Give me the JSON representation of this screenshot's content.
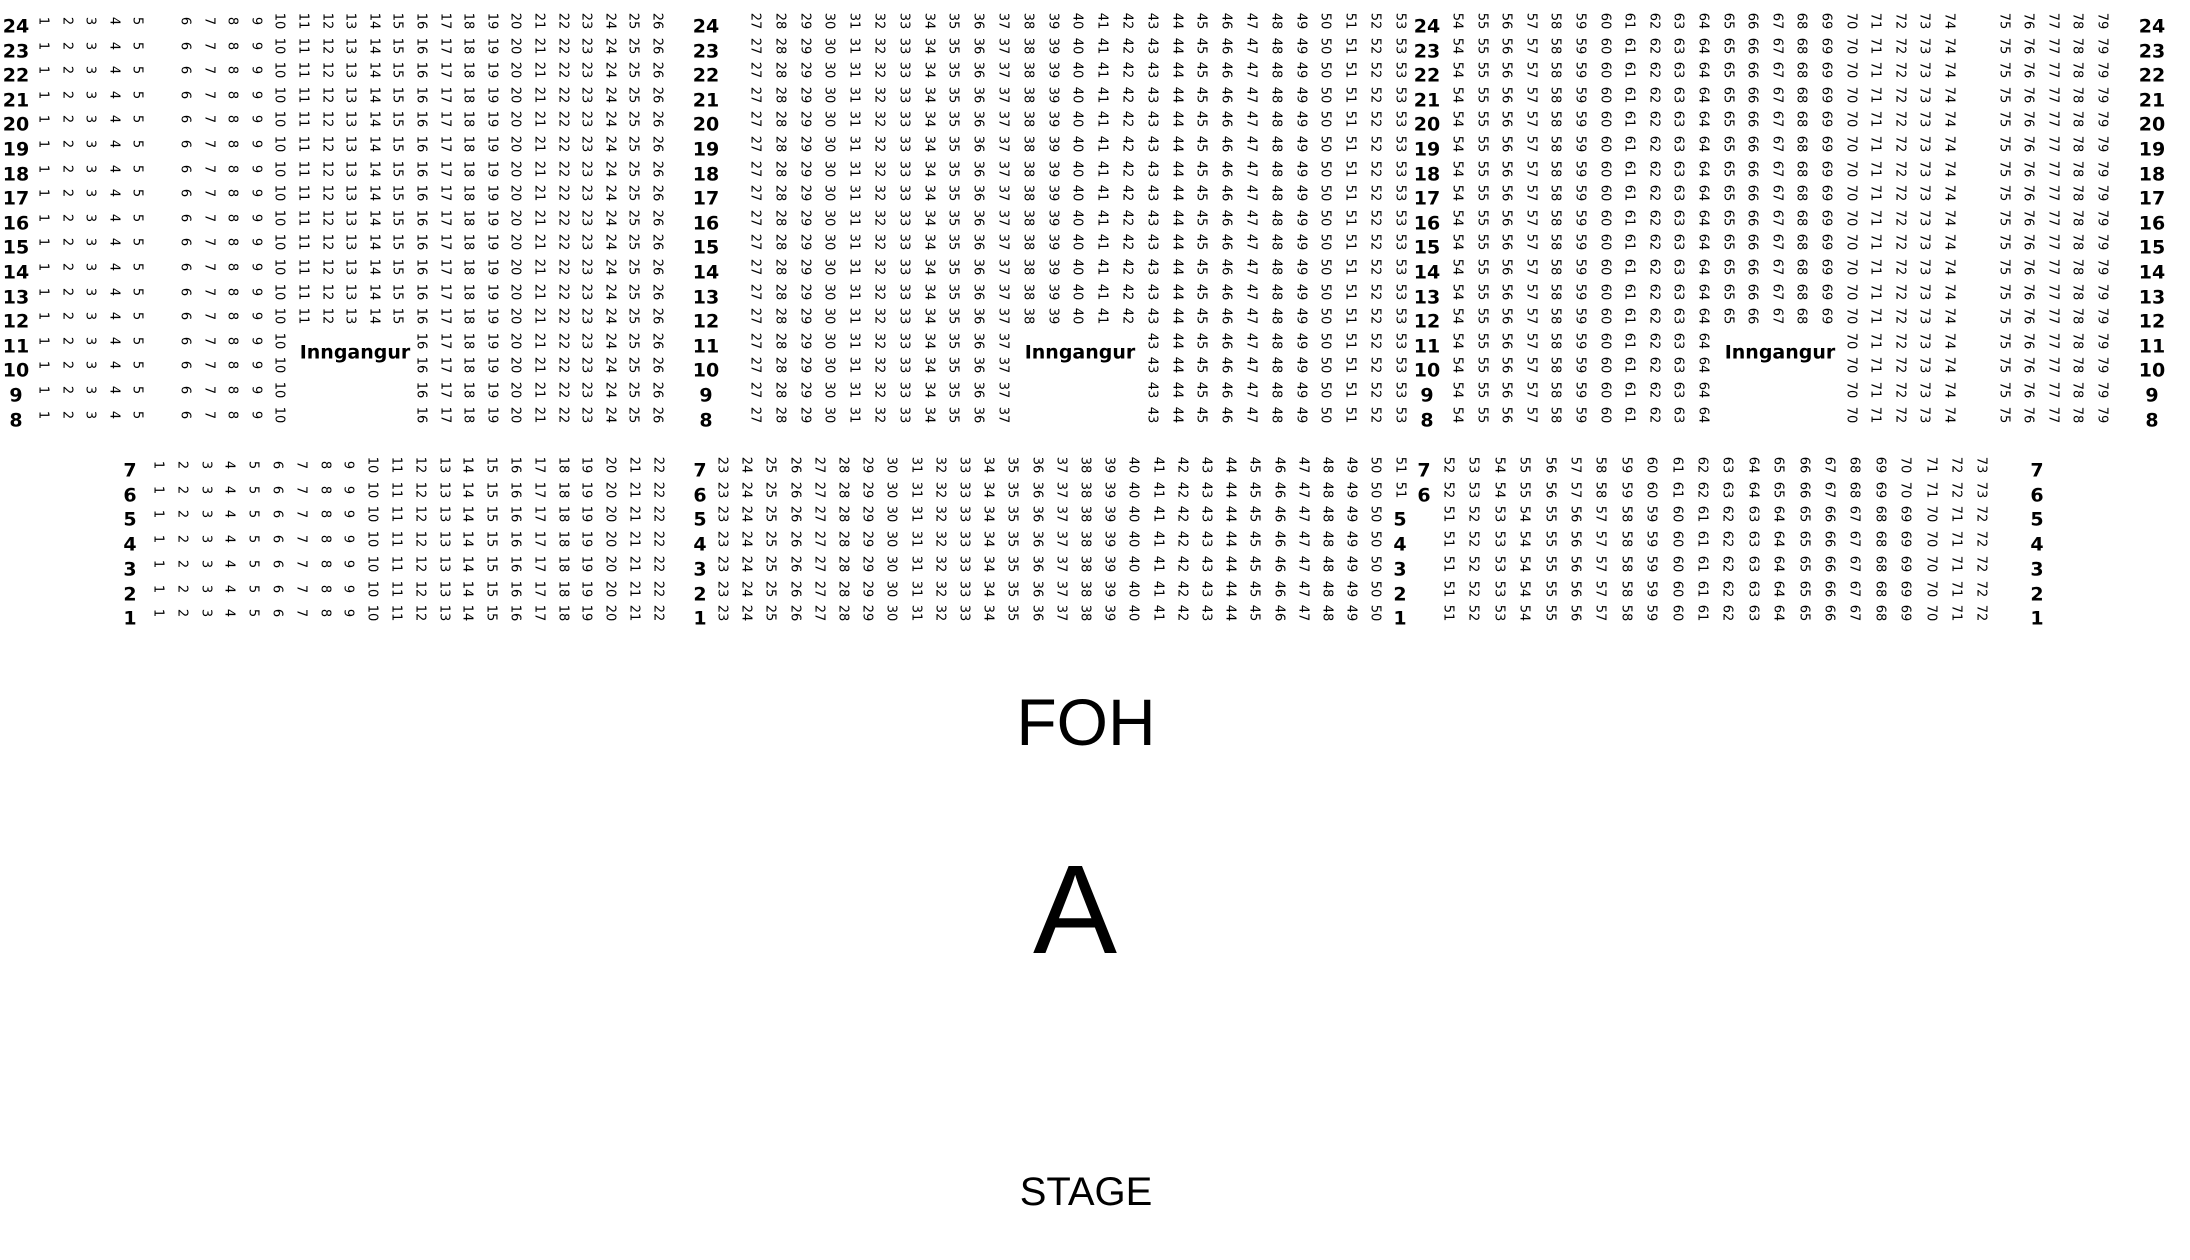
{
  "page": {
    "background_color": "#ffffff",
    "text_color": "#000000"
  },
  "labels": {
    "entrance": "Inngangur",
    "foh": "FOH",
    "section": "A",
    "stage": "STAGE"
  },
  "upper_section": {
    "rows": [
      24,
      23,
      22,
      21,
      20,
      19,
      18,
      17,
      16,
      15,
      14,
      13,
      12,
      11,
      10,
      9,
      8
    ],
    "row_label_columns": 4,
    "blocks": [
      {
        "id": "left",
        "seats": [
          1,
          26
        ],
        "aisle_gap_after_seat": 5,
        "entrance": {
          "rows": [
            11,
            10,
            9,
            8
          ],
          "missing_seats": [
            11,
            15
          ],
          "label": "Inngangur"
        }
      },
      {
        "id": "middle",
        "seats": [
          27,
          53
        ],
        "entrance": {
          "rows": [
            11,
            10,
            9,
            8
          ],
          "missing_seats": [
            38,
            42
          ],
          "label": "Inngangur"
        }
      },
      {
        "id": "right",
        "seats": [
          54,
          79
        ],
        "aisle_gap_after_seat": 74,
        "entrance": {
          "rows": [
            11,
            10,
            9,
            8
          ],
          "missing_seats": [
            65,
            69
          ],
          "label": "Inngangur"
        }
      }
    ]
  },
  "lower_section": {
    "rows": [
      7,
      6,
      5,
      4,
      3,
      2,
      1
    ],
    "row_label_columns": 4,
    "blocks": [
      {
        "id": "left",
        "row_seats": {
          "7": [
            1,
            22
          ],
          "6": [
            1,
            22
          ],
          "5": [
            1,
            22
          ],
          "4": [
            1,
            22
          ],
          "3": [
            1,
            22
          ],
          "2": [
            1,
            22
          ],
          "1": [
            1,
            22
          ]
        }
      },
      {
        "id": "middle",
        "row_seats": {
          "7": [
            23,
            51
          ],
          "6": [
            23,
            51
          ],
          "5": [
            23,
            50
          ],
          "4": [
            23,
            50
          ],
          "3": [
            23,
            50
          ],
          "2": [
            23,
            50
          ],
          "1": [
            23,
            50
          ]
        }
      },
      {
        "id": "right",
        "row_seats": {
          "7": [
            52,
            73
          ],
          "6": [
            52,
            73
          ],
          "5": [
            51,
            72
          ],
          "4": [
            51,
            72
          ],
          "3": [
            51,
            72
          ],
          "2": [
            51,
            72
          ],
          "1": [
            51,
            72
          ]
        }
      }
    ]
  }
}
